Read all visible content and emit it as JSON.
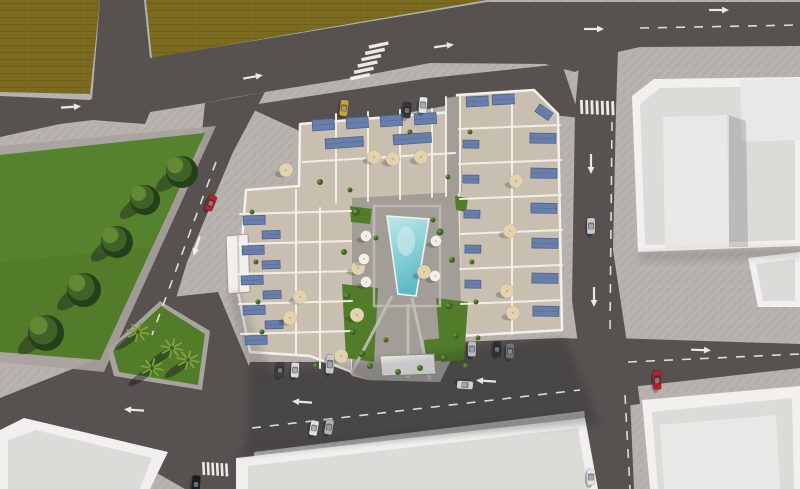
{
  "meta": {
    "description": "Aerial 3D architectural render of a residential apartment complex with rooftop terraces, solar panels, parasols and a central swimming pool courtyard, surrounded by roads, parked cars, a grass park with trees and palms, an olive field and neighbouring white flat-roofed buildings",
    "view": "top-down aerial render",
    "width": 800,
    "height": 489
  },
  "colors": {
    "road": "#575150",
    "road-dark": "#4c4747",
    "sidewalk": "#b6b1ac",
    "sidewalk-line": "#a8a39e",
    "field": "#7a6b21",
    "field-line": "#6e6018",
    "grass": "#527c2a",
    "grass-light": "#5d8a30",
    "tree-dark": "#24401a",
    "tree-mid": "#3f6326",
    "tree-light": "#678d37",
    "palm": "#7fa23c",
    "roof": "#dcdbd8",
    "roof-hi": "#e9e8e6",
    "roof-frame": "#f1f0ee",
    "wall": "#f3f0ea",
    "floor": "#c8bfb0",
    "deck": "#a29d97",
    "path": "#c4bfb8",
    "panel": "#687fab",
    "panel-dark": "#4b5d85",
    "pool-a": "#bde8e8",
    "pool-b": "#5cb9c6",
    "umb-tan": "#e3d2ae",
    "umb-white": "#f2efe6",
    "marking": "#f5f5f2",
    "shadow": "#10131c"
  },
  "scene": {
    "cars": [
      [
        211,
        203,
        112,
        "#b5222b",
        16
      ],
      [
        657,
        380,
        88,
        "#b5202a",
        19
      ],
      [
        591,
        226,
        90,
        "#c7c9cc",
        16
      ],
      [
        591,
        477,
        90,
        "#e3e4e6",
        16
      ],
      [
        344,
        108,
        97,
        "#c9a33b",
        16
      ],
      [
        407,
        110,
        95,
        "#34373c",
        16
      ],
      [
        423,
        105,
        95,
        "#e4e5e6",
        16
      ],
      [
        280,
        370,
        93,
        "#3c4045",
        15
      ],
      [
        295,
        370,
        93,
        "#dadbdc",
        15
      ],
      [
        330,
        364,
        93,
        "#c6c8ca",
        19
      ],
      [
        472,
        349,
        91,
        "#babdbf",
        15
      ],
      [
        497,
        349,
        91,
        "#2e3134",
        15
      ],
      [
        510,
        351,
        91,
        "#6f7377",
        15
      ],
      [
        465,
        385,
        184,
        "#d0d2d4",
        16
      ],
      [
        314,
        428,
        100,
        "#e0e1e3",
        15
      ],
      [
        329,
        427,
        100,
        "#aeb1b5",
        15
      ],
      [
        196,
        484,
        95,
        "#1b1c1e",
        17
      ]
    ],
    "trees": [
      [
        180,
        170,
        16
      ],
      [
        143,
        198,
        15
      ],
      [
        115,
        240,
        16
      ],
      [
        82,
        288,
        17
      ],
      [
        44,
        331,
        18
      ]
    ],
    "palms": [
      [
        138,
        332
      ],
      [
        172,
        348
      ],
      [
        152,
        368
      ],
      [
        188,
        360
      ]
    ],
    "shrubs": [
      [
        356,
        212,
        4
      ],
      [
        344,
        252,
        3
      ],
      [
        347,
        296,
        3.5
      ],
      [
        353,
        332,
        3
      ],
      [
        362,
        354,
        3.5
      ],
      [
        370,
        366,
        3
      ],
      [
        440,
        232,
        3.5
      ],
      [
        452,
        260,
        3
      ],
      [
        449,
        306,
        3.5
      ],
      [
        456,
        336,
        3
      ],
      [
        444,
        358,
        3.5
      ],
      [
        420,
        368,
        3
      ],
      [
        398,
        372,
        3
      ],
      [
        386,
        340,
        2.5
      ],
      [
        376,
        238,
        2.5
      ],
      [
        433,
        220,
        2.5
      ],
      [
        320,
        182,
        3
      ],
      [
        448,
        177,
        2.5
      ],
      [
        252,
        212,
        2.5
      ],
      [
        256,
        262,
        2.5
      ],
      [
        258,
        302,
        2.5
      ],
      [
        262,
        332,
        2.5
      ],
      [
        470,
        132,
        2.5
      ],
      [
        472,
        262,
        2.5
      ],
      [
        476,
        302,
        2.5
      ],
      [
        316,
        366,
        3
      ],
      [
        410,
        132,
        2.5
      ],
      [
        466,
        366,
        3
      ],
      [
        478,
        338,
        2.5
      ],
      [
        350,
        190,
        2.5
      ]
    ],
    "umbrellas_white": [
      [
        366,
        236
      ],
      [
        364,
        259
      ],
      [
        366,
        282
      ],
      [
        436,
        241
      ],
      [
        435,
        276
      ]
    ],
    "umbrellas_tan": [
      [
        286,
        170
      ],
      [
        374,
        157
      ],
      [
        393,
        159
      ],
      [
        421,
        157
      ],
      [
        358,
        268
      ],
      [
        424,
        272
      ],
      [
        300,
        297
      ],
      [
        290,
        318
      ],
      [
        357,
        315
      ],
      [
        341,
        356
      ],
      [
        516,
        181
      ],
      [
        510,
        231
      ],
      [
        507,
        291
      ],
      [
        513,
        313
      ]
    ],
    "panels": [
      [
        312,
        120,
        22,
        11,
        -4
      ],
      [
        346,
        118,
        22,
        11,
        -4
      ],
      [
        380,
        116,
        22,
        11,
        -4
      ],
      [
        414,
        114,
        22,
        11,
        -4
      ],
      [
        325,
        139,
        38,
        10,
        -4
      ],
      [
        393,
        135,
        38,
        10,
        -4
      ],
      [
        243,
        216,
        22,
        9,
        -2
      ],
      [
        242,
        246,
        22,
        9,
        -2
      ],
      [
        241,
        276,
        22,
        9,
        -2
      ],
      [
        243,
        306,
        22,
        9,
        -2
      ],
      [
        245,
        336,
        22,
        9,
        -2
      ],
      [
        262,
        231,
        18,
        8,
        -2
      ],
      [
        262,
        261,
        18,
        8,
        -2
      ],
      [
        263,
        291,
        18,
        8,
        -2
      ],
      [
        265,
        321,
        18,
        8,
        -2
      ],
      [
        530,
        133,
        26,
        10,
        1
      ],
      [
        531,
        168,
        26,
        10,
        1
      ],
      [
        531,
        203,
        26,
        10,
        1
      ],
      [
        532,
        238,
        26,
        10,
        1
      ],
      [
        532,
        273,
        26,
        10,
        1
      ],
      [
        533,
        306,
        26,
        10,
        1
      ],
      [
        463,
        140,
        16,
        8,
        1
      ],
      [
        463,
        175,
        16,
        8,
        1
      ],
      [
        464,
        210,
        16,
        8,
        1
      ],
      [
        465,
        245,
        16,
        8,
        1
      ],
      [
        465,
        280,
        16,
        8,
        1
      ],
      [
        466,
        97,
        22,
        10,
        -3
      ],
      [
        492,
        95,
        22,
        10,
        -3
      ],
      [
        540,
        104,
        16,
        9,
        35
      ]
    ],
    "walls": [
      [
        336,
        114,
        336,
        203
      ],
      [
        368,
        112,
        368,
        201
      ],
      [
        400,
        110,
        400,
        199
      ],
      [
        432,
        109,
        432,
        197
      ],
      [
        303,
        162,
        455,
        153
      ],
      [
        446,
        97,
        446,
        196
      ],
      [
        460,
        95,
        460,
        192
      ],
      [
        240,
        214,
        351,
        211
      ],
      [
        239,
        244,
        351,
        241
      ],
      [
        238,
        274,
        352,
        271
      ],
      [
        239,
        304,
        352,
        301
      ],
      [
        241,
        334,
        352,
        331
      ],
      [
        320,
        208,
        320,
        368
      ],
      [
        296,
        190,
        296,
        354
      ],
      [
        459,
        129,
        560,
        125
      ],
      [
        459,
        164,
        561,
        160
      ],
      [
        460,
        199,
        561,
        195
      ],
      [
        460,
        234,
        562,
        230
      ],
      [
        460,
        269,
        562,
        265
      ],
      [
        461,
        304,
        562,
        300
      ],
      [
        512,
        92,
        512,
        334
      ]
    ],
    "arrows": [
      [
        70,
        107,
        -4
      ],
      [
        252,
        77,
        -10
      ],
      [
        443,
        46,
        -8
      ],
      [
        593,
        29,
        0
      ],
      [
        718,
        10,
        0
      ],
      [
        700,
        350,
        2
      ],
      [
        135,
        410,
        184
      ],
      [
        303,
        402,
        184
      ],
      [
        487,
        381,
        184
      ],
      [
        591,
        163,
        90
      ],
      [
        594,
        296,
        90
      ],
      [
        197,
        245,
        108
      ]
    ],
    "dashes": [
      [
        640,
        28,
        800,
        25
      ],
      [
        252,
        428,
        580,
        390
      ],
      [
        628,
        362,
        800,
        354
      ],
      [
        612,
        122,
        610,
        330
      ],
      [
        625,
        395,
        630,
        489
      ],
      [
        216,
        162,
        152,
        335
      ]
    ],
    "crosswalks": [
      [
        580,
        100,
        7,
        5.2,
        0.2,
        2.8,
        14,
        -2
      ],
      [
        350,
        77,
        6,
        3.7,
        -6.3,
        20,
        3.4,
        -12
      ],
      [
        202,
        462,
        6,
        4.6,
        0.3,
        2.6,
        13,
        -3
      ]
    ]
  }
}
